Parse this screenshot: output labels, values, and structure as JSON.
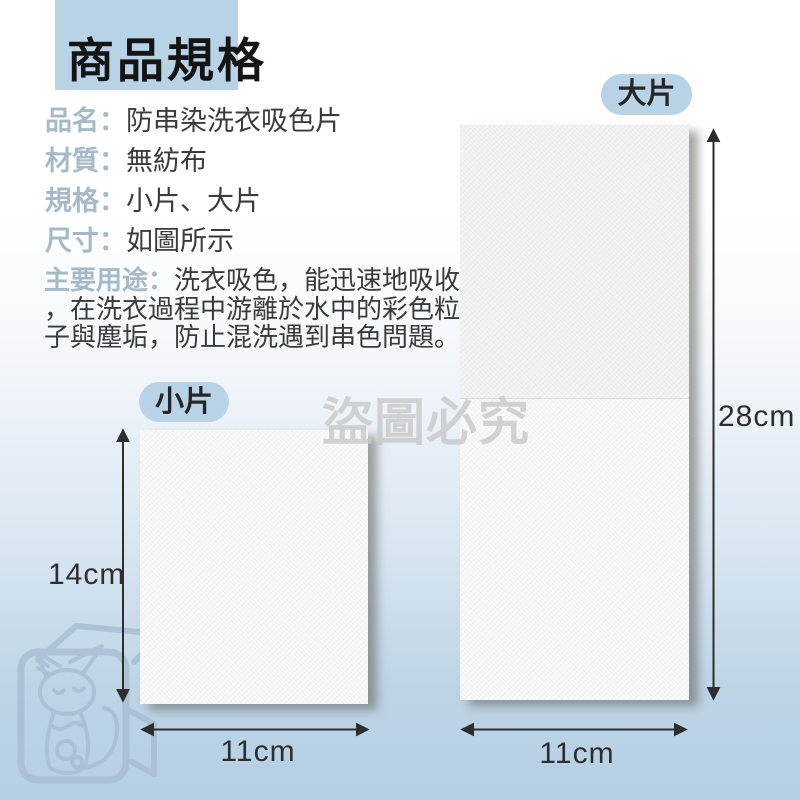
{
  "title": "商品規格",
  "specs": [
    {
      "label": "品名：",
      "value": "防串染洗衣吸色片"
    },
    {
      "label": "材質：",
      "value": "無紡布"
    },
    {
      "label": "規格：",
      "value": "小片、大片"
    },
    {
      "label": "尺寸：",
      "value": "如圖所示"
    },
    {
      "label": "主要用途：",
      "value": "洗衣吸色，能迅速地吸收，在洗衣過程中游離於水中的彩色粒子與塵垢，防止混洗遇到串色問題。"
    }
  ],
  "watermark": {
    "text": "盜圖必究",
    "logo": "cat-in-box-logo"
  },
  "sheets": {
    "large": {
      "badge": "大片",
      "height_label": "28cm",
      "width_label": "11cm"
    },
    "small": {
      "badge": "小片",
      "height_label": "14cm",
      "width_label": "11cm"
    }
  },
  "colors": {
    "accent_blue": "#b9d3e6",
    "label_blue_gray": "#a4bac9",
    "text_dark": "#3b3b3b",
    "background_bottom_blue": "#b5cfe3",
    "sheet_white": "#f6f6f7",
    "watermark_gray": "#c8c8c8",
    "logo_blue": "#a8bfd3",
    "arrow_color": "#2e2e2e"
  }
}
